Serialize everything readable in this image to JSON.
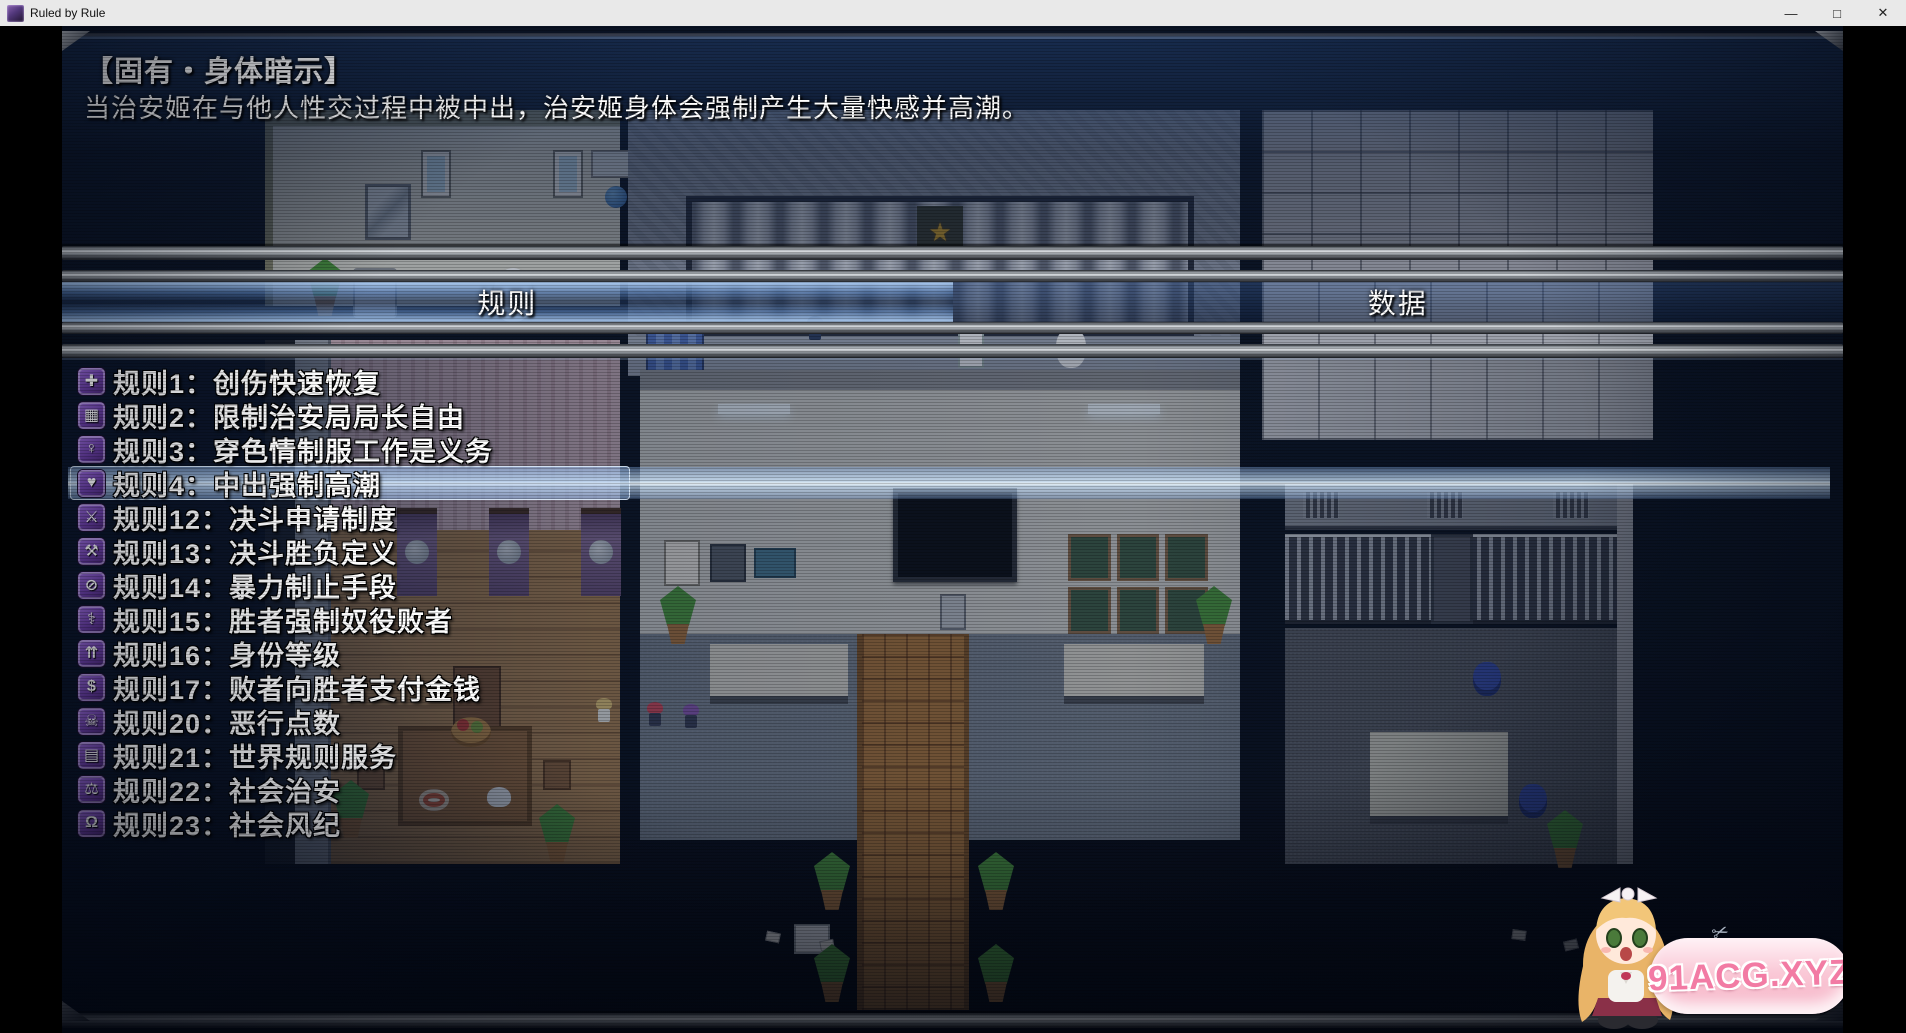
{
  "titlebar": {
    "title": "Ruled by Rule",
    "minimize": "—",
    "maximize": "□",
    "close": "✕"
  },
  "panel": {
    "headline": "【固有・身体暗示】",
    "description": "当治安姬在与他人性交过程中被中出，治安姬身体会强制产生大量快感并高潮。"
  },
  "tabs": [
    {
      "label": "规则",
      "selected": true
    },
    {
      "label": "数据",
      "selected": false
    }
  ],
  "rules": [
    {
      "icon": "✚",
      "icon_name": "medical-cross-icon",
      "label": "规则1：创伤快速恢复",
      "selected": false
    },
    {
      "icon": "▦",
      "icon_name": "jail-bars-icon",
      "label": "规则2：限制治安局局长自由",
      "selected": false
    },
    {
      "icon": "♀",
      "icon_name": "uniform-girl-icon",
      "label": "规则3：穿色情制服工作是义务",
      "selected": false
    },
    {
      "icon": "♥",
      "icon_name": "climax-icon",
      "label": "规则4：中出强制高潮",
      "selected": true
    },
    {
      "icon": "⚔",
      "icon_name": "crossed-swords-icon",
      "label": "规则12：决斗申请制度",
      "selected": false
    },
    {
      "icon": "⚒",
      "icon_name": "verdict-hammer-icon",
      "label": "规则13：决斗胜负定义",
      "selected": false
    },
    {
      "icon": "⊘",
      "icon_name": "prohibition-icon",
      "label": "规则14：暴力制止手段",
      "selected": false
    },
    {
      "icon": "⚕",
      "icon_name": "caduceus-icon",
      "label": "规则15：胜者强制奴役败者",
      "selected": false
    },
    {
      "icon": "⇈",
      "icon_name": "rank-chevrons-icon",
      "label": "规则16：身份等级",
      "selected": false
    },
    {
      "icon": "$",
      "icon_name": "money-bag-icon",
      "label": "规则17：败者向胜者支付金钱",
      "selected": false
    },
    {
      "icon": "☠",
      "icon_name": "villainy-icon",
      "label": "规则20：恶行点数",
      "selected": false
    },
    {
      "icon": "▤",
      "icon_name": "rulebook-icon",
      "label": "规则21：世界规则服务",
      "selected": false
    },
    {
      "icon": "⚖",
      "icon_name": "scales-icon",
      "label": "规则22：社会治安",
      "selected": false
    },
    {
      "icon": "Ω",
      "icon_name": "padlock-icon",
      "label": "规则23：社会风纪",
      "selected": false
    }
  ],
  "watermark": {
    "text": "91ACG.XYZ"
  },
  "colors": {
    "accent_purple": "#6b3fa6",
    "selection_blue": "#aecdf0",
    "panel_navy": "#16325e",
    "metal_gray": "#9aa0a6",
    "watermark_pink": "#f27ba4",
    "emblem_gold": "#d2a22c"
  }
}
